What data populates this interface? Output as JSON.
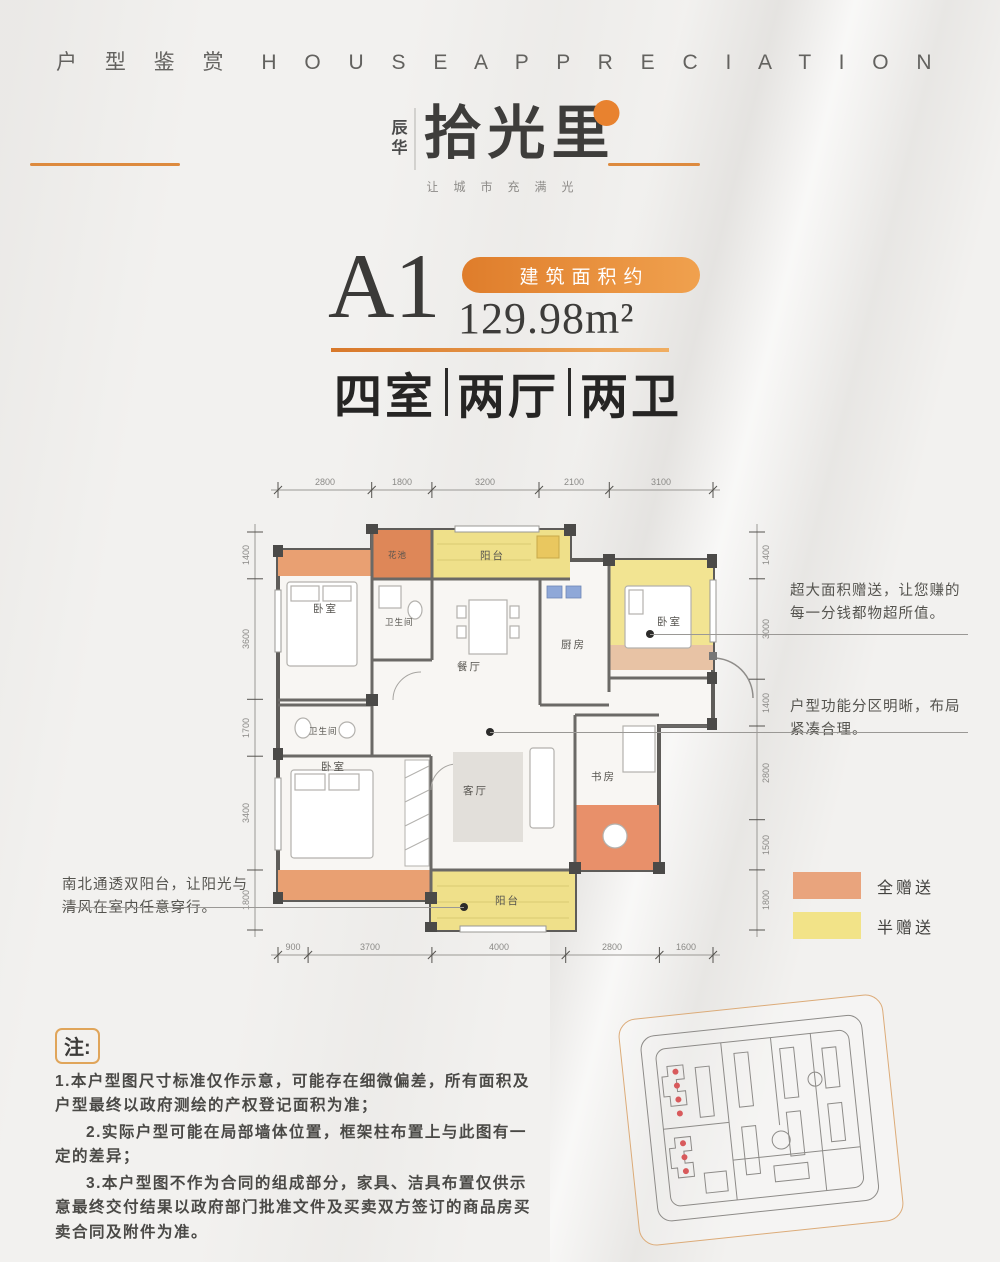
{
  "header": {
    "title_cn": "户 型 鉴 赏",
    "title_en": "H O U S E  A P P R E C I A T I O N"
  },
  "logo": {
    "brand_side": "辰华",
    "brand_main": "拾光里",
    "tagline": "让城市充满光"
  },
  "unit": {
    "name": "A1",
    "area_badge": "建筑面积约",
    "area_value": "129.98m²",
    "layout": [
      "四室",
      "两厅",
      "两卫"
    ]
  },
  "floorplan": {
    "dims_top": [
      "2800",
      "1800",
      "3200",
      "2100",
      "3100"
    ],
    "dims_bottom": [
      "900",
      "3700",
      "4000",
      "2800",
      "1600"
    ],
    "dims_left": [
      "1400",
      "3600",
      "1700",
      "3400",
      "1800"
    ],
    "dims_right": [
      "1400",
      "3000",
      "1400",
      "2800",
      "1500",
      "1800"
    ],
    "labels": {
      "bedroom_top_left": "卧室",
      "flower_bed": "花池",
      "balcony_top": "阳台",
      "bath_top": "卫生间",
      "dining": "餐厅",
      "kitchen": "厨房",
      "bedroom_top_right": "卧室",
      "bath_mid": "卫生间",
      "bedroom_master": "卧室",
      "living": "客厅",
      "study": "书房",
      "balcony_bottom": "阳台"
    }
  },
  "annotations": {
    "right_top": "超大面积赠送，让您赚的每一分钱都物超所值。",
    "right_bottom": "户型功能分区明晰，布局紧凑合理。",
    "left_bottom": "南北通透双阳台，让阳光与清风在室内任意穿行。"
  },
  "legend": {
    "full": {
      "label": "全赠送",
      "color": "#E9A47D"
    },
    "half": {
      "label": "半赠送",
      "color": "#F2E388"
    }
  },
  "notes": {
    "tag": "注:",
    "item1": "1.本户型图尺寸标准仅作示意，可能存在细微偏差，所有面积及户型最终以政府测绘的产权登记面积为准；",
    "item2": "2.实际户型可能在局部墙体位置，框架柱布置上与此图有一定的差异；",
    "item3": "3.本户型图不作为合同的组成部分，家具、洁具布置仅供示意最终交付结果以政府部门批准文件及买卖双方签订的商品房买卖合同及附件为准。"
  },
  "colors": {
    "accent": "#E8832F",
    "gift_full": "#E9A072",
    "gift_half": "#F0E28C",
    "wall": "#5B5B5B"
  }
}
